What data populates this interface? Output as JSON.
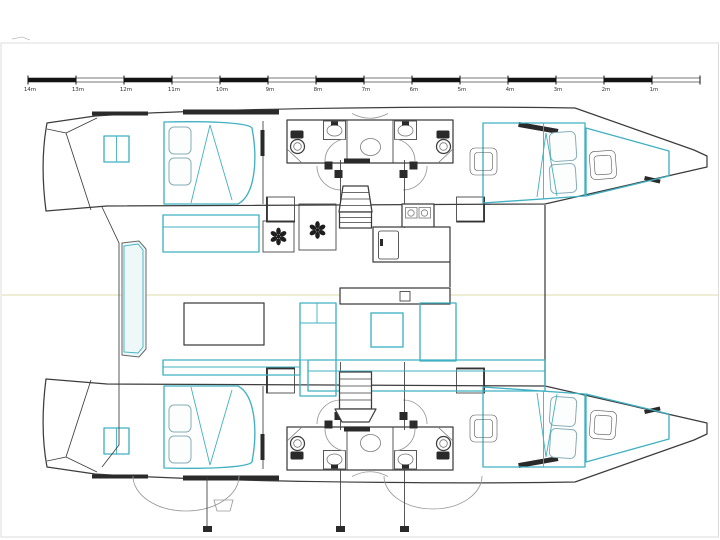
{
  "scale_bar": {
    "unit_labels": [
      "14m",
      "13m",
      "12m",
      "11m",
      "10m",
      "9m",
      "8m",
      "7m",
      "6m",
      "5m",
      "4m",
      "3m",
      "2m",
      "1m"
    ],
    "start_x": 28,
    "end_x": 700,
    "tick_spacing": 48,
    "bar_y": 78,
    "bar_height": 4,
    "label_y": 91
  },
  "colors": {
    "outline": "#3d3d3d",
    "furniture": "#41b1c2",
    "furniture_fill": "#eef8f9",
    "centerline": "#e9e9c5",
    "frame": "#dcdcdc",
    "bar_dark": "#111111",
    "dark_fixture": "#2a2a2a"
  },
  "symbols": {
    "table_symbol": "six-petal-flower",
    "stair_hatch": "diagonal-hatch"
  }
}
